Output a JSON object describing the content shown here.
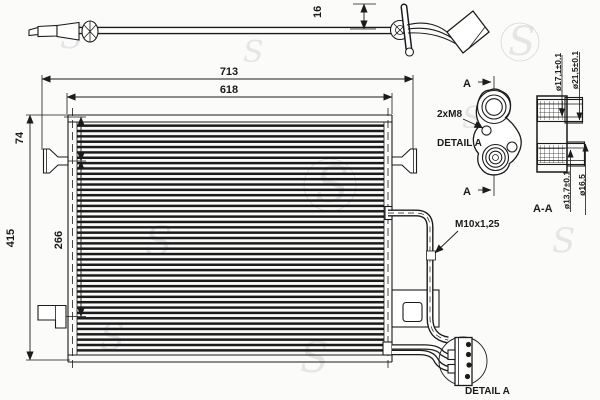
{
  "drawing": {
    "type": "condenser-technical-drawing",
    "colors": {
      "line": "#1b1b1b",
      "background": "#fbfbfa",
      "watermark": "#cccccc"
    },
    "watermark": {
      "glyph": "S"
    },
    "dimensions": {
      "pipe_offset": "16",
      "overall_width": "713",
      "core_width": "618",
      "overall_height": "415",
      "mount_span": "266",
      "top_mount_offset": "74"
    },
    "callouts": {
      "bolt_thread": "2xM8",
      "detail_view_label": "DETAIL A",
      "detail_balloon_caption": "DETAIL A",
      "section_caption": "A-A",
      "section_arrow_top": "A",
      "section_arrow_bottom": "A",
      "fitting_thread": "M10x1,25",
      "dia_top_inner": "ø17,1±0.1",
      "dia_top_outer": "ø21,5±0.1",
      "dia_bottom_inner": "ø13,7±0.1",
      "dia_bottom_outer": "ø16,5"
    }
  }
}
